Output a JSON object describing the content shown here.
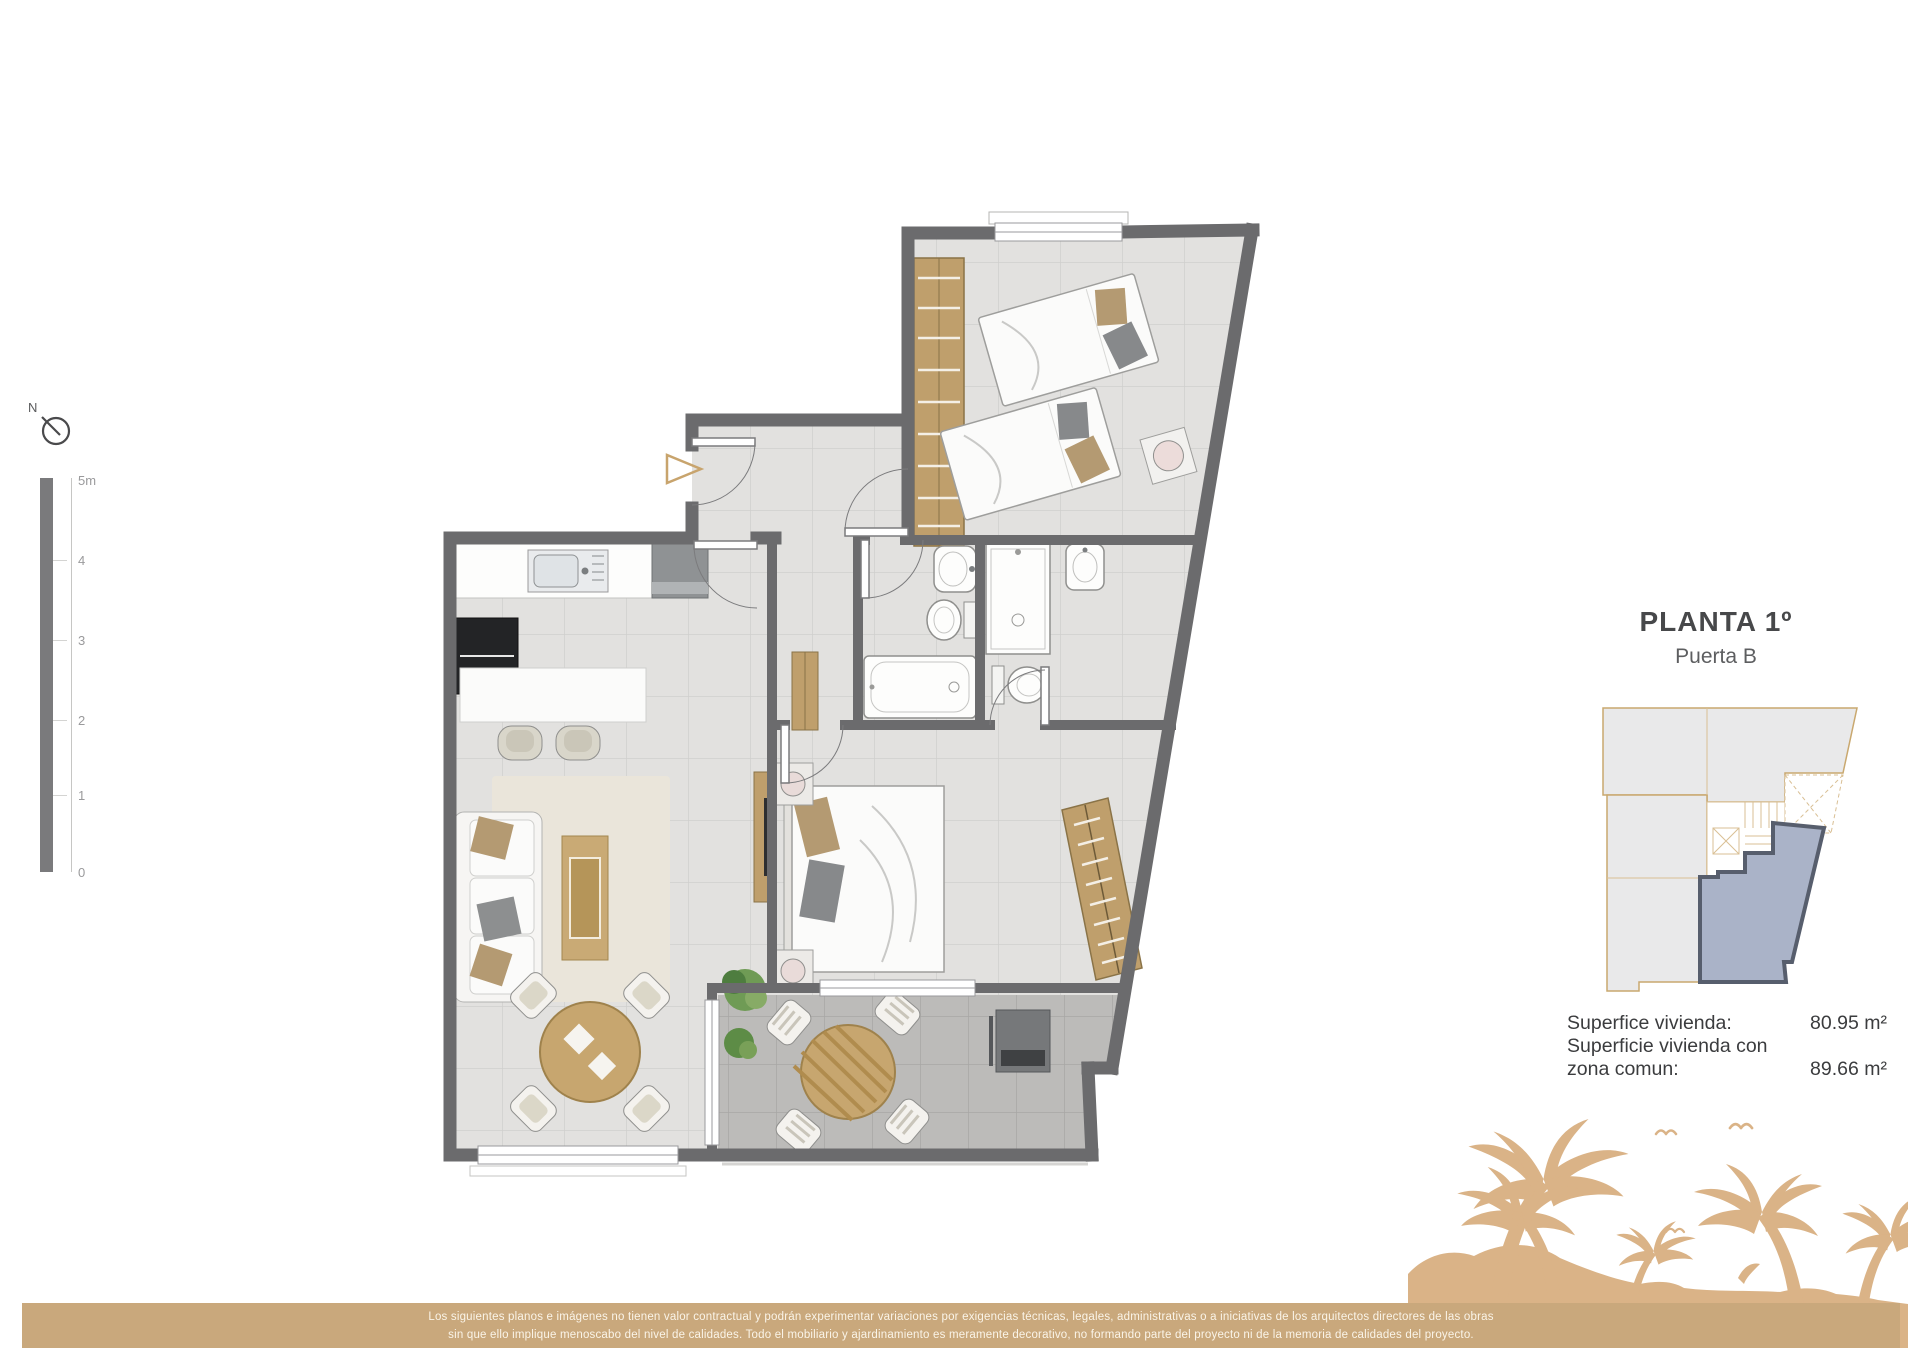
{
  "header": {
    "title": "PLANTA 1º",
    "subtitle": "Puerta B"
  },
  "compass": {
    "label": "N"
  },
  "scale": {
    "ticks": [
      "5m",
      "4",
      "3",
      "2",
      "1",
      "0"
    ]
  },
  "areas": {
    "row1_label": "Superfice vivienda:",
    "row1_value": "80.95 m²",
    "row2_label_line1": "Superficie vivienda con",
    "row2_label_line2": "zona comun:",
    "row2_value": "89.66 m²"
  },
  "footer": {
    "line1": "Los siguientes planos e imágenes no tienen valor contractual y podrán experimentar variaciones por exigencias técnicas, legales, administrativas o a iniciativas de los arquitectos directores de las obras",
    "line2": "sin que ello implique menoscabo del nivel de calidades. Todo el mobiliario y ajardinamiento es meramente decorativo, no formando parte del proyecto ni de la memoria de calidades del proyecto."
  },
  "colors": {
    "wall": "#6b6b6d",
    "floor": "#e2e1df",
    "terrace_floor": "#bcbbb9",
    "wood": "#bf9f6c",
    "accent_tan": "#c9a87c",
    "palm": "#dab387",
    "key_unit_fill": "#aab3c8",
    "key_unit_stroke": "#575e6d"
  }
}
